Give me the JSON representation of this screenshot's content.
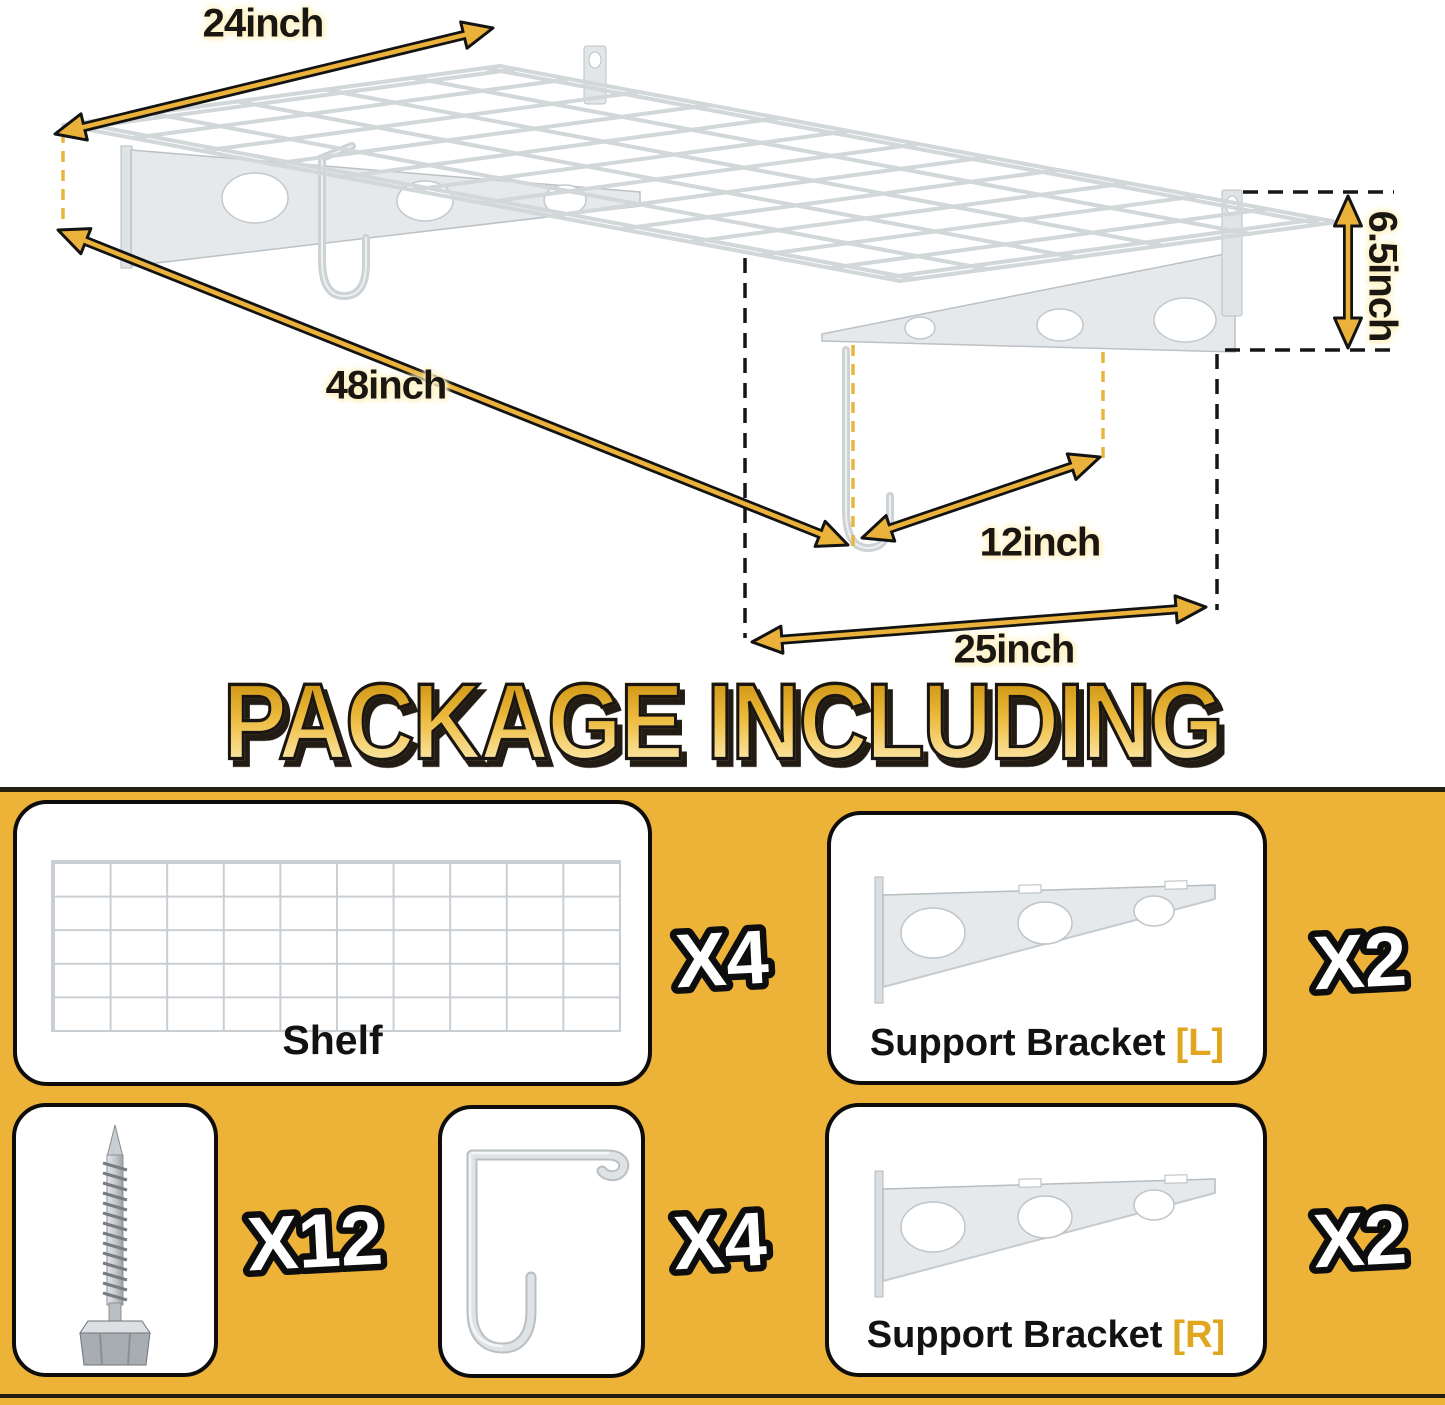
{
  "title": "PACKAGE INCLUDING",
  "diagram": {
    "labels": {
      "top_width": "24inch",
      "length": "48inch",
      "bracket_height": "6.5inch",
      "bracket_gap": "12inch",
      "bracket_depth": "25inch"
    },
    "icons": {
      "shelf": "wire-grid-shelf-icon",
      "bracket_left": "support-bracket-left-icon",
      "bracket_right": "support-bracket-right-icon",
      "hook": "j-hook-icon",
      "arrows": "dimension-arrow-icon"
    }
  },
  "package": {
    "shelf": {
      "label": "Shelf",
      "count": "X4",
      "icon": "wire-grid-shelf-icon"
    },
    "bracket_l": {
      "label": "Support Bracket",
      "suffix": "[L]",
      "count": "X2",
      "icon": "support-bracket-icon"
    },
    "screws": {
      "count": "X12",
      "icon": "screw-icon"
    },
    "hooks": {
      "count": "X4",
      "icon": "j-hook-icon"
    },
    "bracket_r": {
      "label": "Support Bracket",
      "suffix": "[R]",
      "count": "X2",
      "icon": "support-bracket-icon"
    }
  },
  "colors": {
    "panel_yellow": "#EDB339",
    "arrow_gold": "#EBB23B",
    "accent_gold": "#DFA61E",
    "title_gradient_top": "#C88D0A",
    "title_gradient_bottom": "#FFF2C2",
    "metal_gray": "#D2D7DA"
  }
}
